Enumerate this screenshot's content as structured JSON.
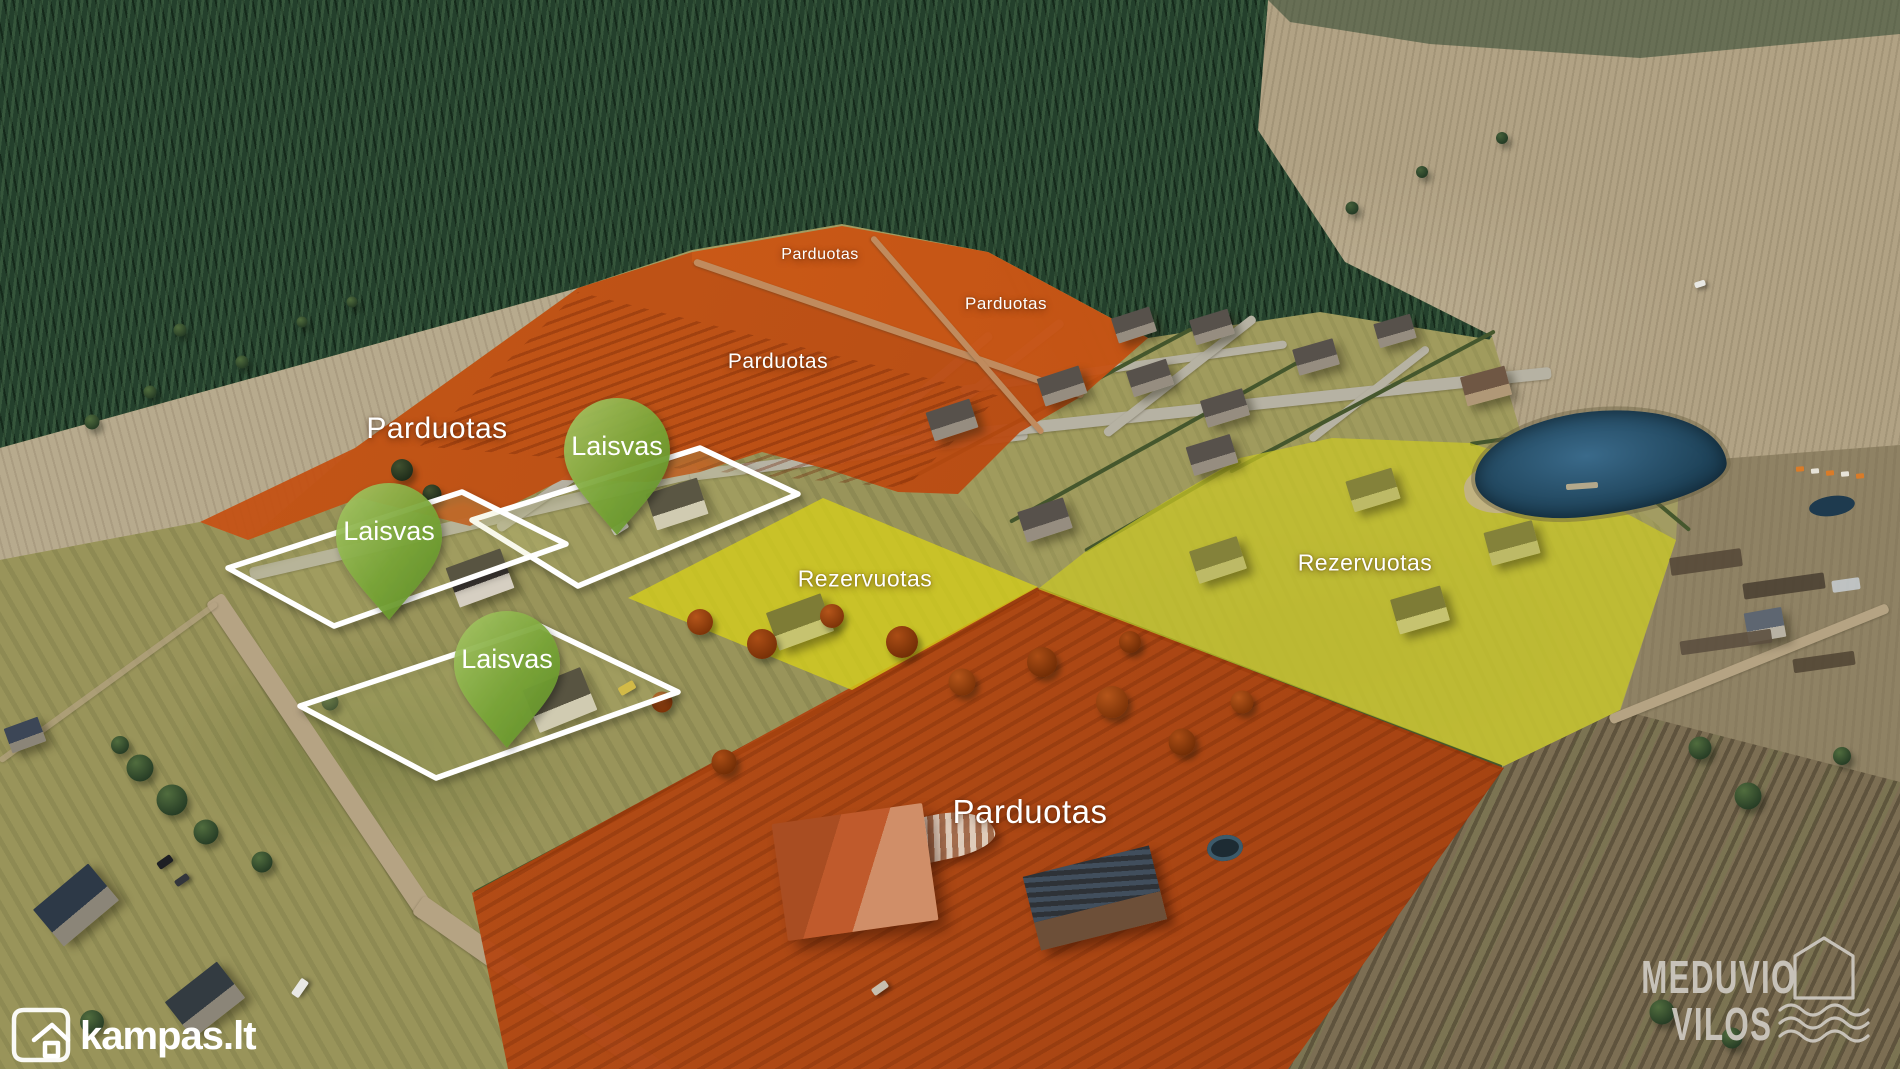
{
  "map": {
    "zones": [
      {
        "id": "sold-north-strip-1",
        "status": "sold",
        "label": "Parduotas"
      },
      {
        "id": "sold-north-strip-2",
        "status": "sold",
        "label": "Parduotas"
      },
      {
        "id": "sold-field-center",
        "status": "sold",
        "label": "Parduotas"
      },
      {
        "id": "sold-west-field",
        "status": "sold",
        "label": "Parduotas"
      },
      {
        "id": "sold-estate-south",
        "status": "sold",
        "label": "Parduotas"
      },
      {
        "id": "reserved-center",
        "status": "reserved",
        "label": "Rezervuotas"
      },
      {
        "id": "reserved-east",
        "status": "reserved",
        "label": "Rezervuotas"
      },
      {
        "id": "free-plot-north",
        "status": "free",
        "label": "Laisvas"
      },
      {
        "id": "free-plot-west",
        "status": "free",
        "label": "Laisvas"
      },
      {
        "id": "free-plot-south",
        "status": "free",
        "label": "Laisvas"
      }
    ],
    "status_colors": {
      "sold": "#c25010",
      "reserved": "#d5d01c",
      "free_pin": "#76a233",
      "plot_outline": "#ffffff"
    }
  },
  "branding": {
    "kampas": {
      "text": "kampas.lt",
      "icon": "kampas-corner-house-icon"
    },
    "developer": {
      "name_line1": "MEDUVIO",
      "name_line2": "VILOS",
      "icons": [
        "house-outline-icon",
        "water-waves-icon"
      ]
    }
  }
}
